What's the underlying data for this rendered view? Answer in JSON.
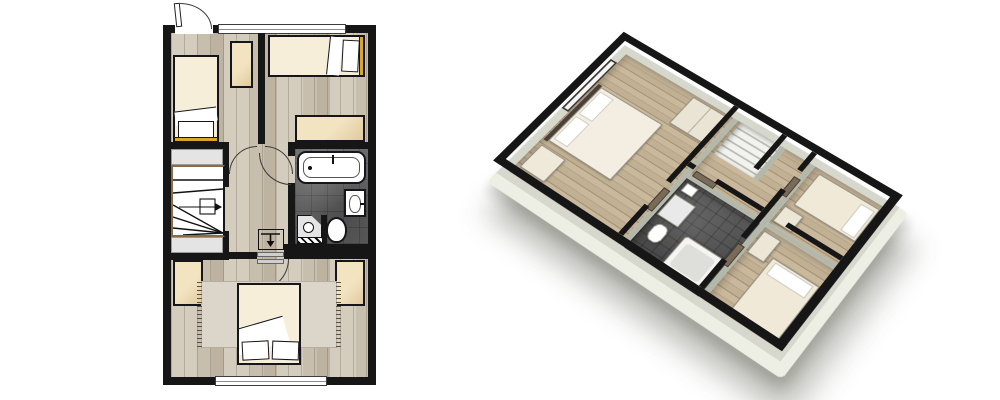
{
  "canvas": {
    "width": 1000,
    "height": 400,
    "background": "#ffffff"
  },
  "colors": {
    "wall": "#161616",
    "wood_a": "#d4ccbd",
    "wood_b": "#c7bead",
    "wood_c": "#beb3a1",
    "wood_line": "#a59b89",
    "tile_a": "#6b6b6b",
    "tile_b": "#585858",
    "cream": "#f2e3c1",
    "cream_dark": "#e0cb9e",
    "blanket": "#f6eed8",
    "rug": "#dcd5c9",
    "landing": "#e4e4e4",
    "stair_brown": "#8a6b4a",
    "gold": "#d9a62e",
    "face": "#d6d8cd",
    "face_dark": "#b4b8ab",
    "base": "#edeee4",
    "wood3d_a": "#c9b89c",
    "wood3d_b": "#b4a283",
    "wood3d_c": "#c1b093",
    "wood3d_line": "#9c8a6e",
    "tile3d": "#5a5a5a",
    "door_brown": "#7a6a58"
  },
  "views": {
    "plan_2d": {
      "kind": "2d-top-down-floor-plan",
      "rooms": [
        "bedroom-top-left",
        "bedroom-top-right",
        "hallway",
        "staircase",
        "bathroom",
        "master-bedroom"
      ],
      "furniture": [
        "single-bed",
        "tall-wardrobe",
        "single-bed",
        "sideboard",
        "winder-staircase",
        "bathtub",
        "wash-basin",
        "toilet",
        "corner-shower-unit",
        "radiator",
        "double-bed",
        "rug",
        "wardrobe-left",
        "wardrobe-right"
      ],
      "openings": [
        "entry-door-with-swing-arc",
        "top-window",
        "bottom-window",
        "interior-door-arcs",
        "stair-landing-thresholds",
        "direction-arrow-symbol"
      ]
    },
    "plan_3d": {
      "kind": "3d-isometric-floor-plan",
      "rotation_deg": 37,
      "rooms": [
        "master-bedroom",
        "hallway",
        "staircase",
        "bathroom",
        "bedroom-east",
        "bedroom-south"
      ],
      "furniture": [
        "double-bed",
        "wardrobe",
        "dresser",
        "wash-basin",
        "shower-tray",
        "toilet",
        "bathtub",
        "single-bed-east",
        "dresser-east",
        "wardrobe-south",
        "single-bed-south"
      ],
      "features": [
        "black-extruded-walls",
        "cream-base-slab",
        "drop-shadow",
        "window-in-northwest-wall",
        "brown-door-panels"
      ]
    }
  }
}
